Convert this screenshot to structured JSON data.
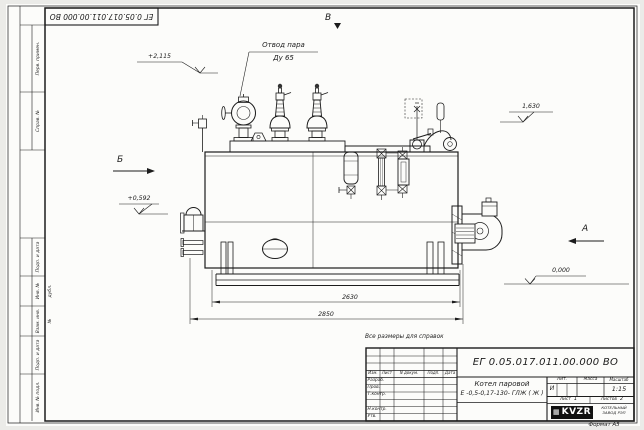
{
  "sheet": {
    "background": "#ebebe8",
    "paper": "#fcfcfa",
    "ink": "#1c1c1c",
    "top_stamp_doc_number": "ЕГ 0.05.017.011.00.000  ВО",
    "reference_note": "Все размеры для справок",
    "format_note": "Формат А3"
  },
  "margin_boxes": {
    "perv_primen": "Перв. примен.",
    "sprav_no": "Справ. №",
    "podp_data_1": "Подп. и дата",
    "inv_no_dubl": "Инв. № дубл.",
    "vzam_inv_no": "Взам. инв. №",
    "podp_data_2": "Подп. и дата",
    "inv_no_podl": "Инв. № подл."
  },
  "drawing": {
    "callout": {
      "line1": "Отвод пара",
      "line2": "Ду 65"
    },
    "views": {
      "top": "В",
      "left": "Б",
      "right": "А"
    },
    "elevations": {
      "valves_top": "+2,115",
      "left_mid": "+0,592",
      "right_top": "1,630",
      "ground": "0,000"
    },
    "dimensions": {
      "shell_length": "2630",
      "overall_length": "2850"
    }
  },
  "title_block": {
    "doc_number": "ЕГ 0.05.017.011.00.000  ВО",
    "name_line1": "Котел паровой",
    "name_line2": "Е -0,5-0,17-130- ГЛЖ ( Ж )",
    "rev_headers": {
      "izm": "Изм.",
      "list": "Лист",
      "n_dokum": "N докум.",
      "podp": "Подп.",
      "data": "Дата"
    },
    "sig_labels": {
      "razrab": "Разраб.",
      "prov": "Пров.",
      "t_kontr": "Т.контр.",
      "n_kontr": "Н.контр.",
      "utv": "Утв."
    },
    "lit_label": "Лит.",
    "lit_value": "И",
    "mass_label": "Масса",
    "scale_label": "Масштаб",
    "scale_value": "1:15",
    "sheet_label": "Лист",
    "sheet_number": "1",
    "sheets_label": "Листов",
    "sheets_total": "2",
    "logo_text": "KVZR",
    "company_line1": "КОТЕЛЬНЫЙ",
    "company_line2": "ЗАВОД РЭП"
  }
}
